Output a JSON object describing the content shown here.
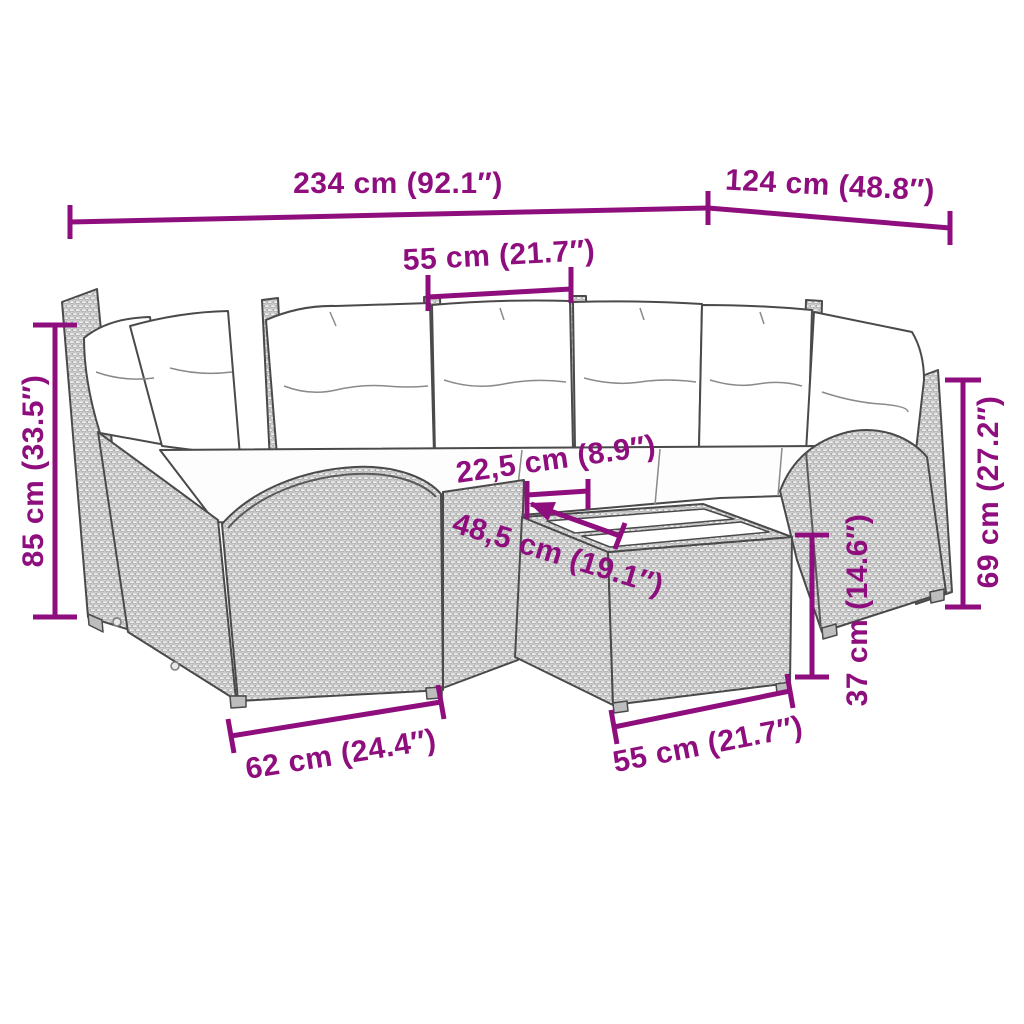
{
  "diagram": {
    "illustration": "garden-corner-sofa-set-with-coffee-table",
    "accent_color": "#8F0E7E",
    "line_color": "#4a4a4a",
    "measurements": [
      {
        "id": "overall-width",
        "label": "234 cm (92.1″)"
      },
      {
        "id": "overall-depth",
        "label": "124 cm (48.8″)"
      },
      {
        "id": "seat-width",
        "label": "55 cm (21.7″)"
      },
      {
        "id": "back-height",
        "label": "85 cm (33.5″)"
      },
      {
        "id": "table-clearance",
        "label": "22,5 cm (8.9″)"
      },
      {
        "id": "table-depth",
        "label": "48,5 cm (19.1″)"
      },
      {
        "id": "side-height",
        "label": "69 cm (27.2″)"
      },
      {
        "id": "table-height",
        "label": "37 cm (14.6″)"
      },
      {
        "id": "module-width",
        "label": "62 cm (24.4″)"
      },
      {
        "id": "table-width",
        "label": "55 cm (21.7″)"
      }
    ]
  }
}
